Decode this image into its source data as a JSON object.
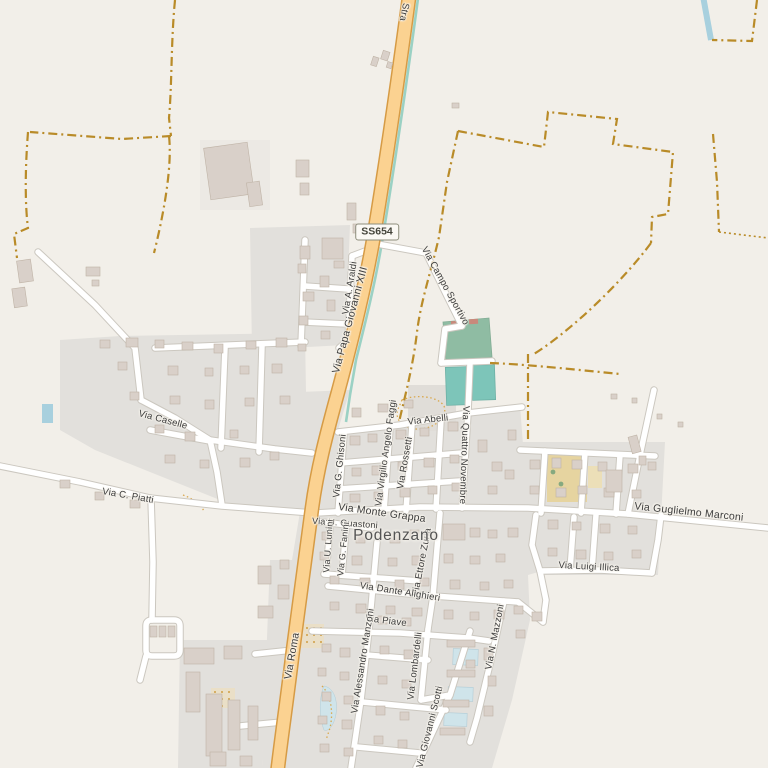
{
  "town": {
    "name": "Podenzano"
  },
  "road_shield": {
    "ref": "SS654"
  },
  "street_labels": [
    {
      "id": "strada-top",
      "text": "Stra"
    },
    {
      "id": "via-a-araldi",
      "text": "Via A. Araldi"
    },
    {
      "id": "via-papa-giovanni-xiii",
      "text": "Via Papa Giovanni XIII"
    },
    {
      "id": "via-campo-sportivo",
      "text": "Via Campo Sportivo"
    },
    {
      "id": "via-caselle",
      "text": "Via Caselle"
    },
    {
      "id": "via-c-piatti",
      "text": "Via C. Piatti"
    },
    {
      "id": "via-abelli",
      "text": "Via Abelli"
    },
    {
      "id": "via-quattro-novembre",
      "text": "Via Quattro Novembre"
    },
    {
      "id": "via-g-ghisoni",
      "text": "Via G. Ghisoni"
    },
    {
      "id": "via-virgilio-angelo-faggi",
      "text": "Via Virgilio Angelo Faggi"
    },
    {
      "id": "via-rossetti",
      "text": "Via Rossetti"
    },
    {
      "id": "via-monte-grappa",
      "text": "Via Monte Grappa"
    },
    {
      "id": "via-u-guastoni",
      "text": "Via U. Guastoni"
    },
    {
      "id": "via-u-lunini",
      "text": "Via U. Lunini"
    },
    {
      "id": "via-g-fanini",
      "text": "Via G. Fanini"
    },
    {
      "id": "via-ettore-zurla",
      "text": "Via Ettore Zurla"
    },
    {
      "id": "via-dante-alighieri",
      "text": "Via Dante Alighieri"
    },
    {
      "id": "via-piave",
      "text": "Via Piave"
    },
    {
      "id": "via-alessandro-manzoni",
      "text": "Via Alessandro Manzoni"
    },
    {
      "id": "via-lombardelli",
      "text": "Via Lombardelli"
    },
    {
      "id": "via-giovanni-scotti",
      "text": "Via Giovanni Scotti"
    },
    {
      "id": "via-n-mazzoni",
      "text": "Via N. Mazzoni"
    },
    {
      "id": "via-guglielmo-marconi",
      "text": "Via Guglielmo Marconi"
    },
    {
      "id": "via-luigi-illica",
      "text": "Via Luigi Illica"
    },
    {
      "id": "via-roma",
      "text": "Via Roma"
    }
  ],
  "colors": {
    "background": "#f2efe9",
    "residential": "#e2e0dc",
    "building_fill": "#d9d0c9",
    "building_stroke": "#bfb3a6",
    "primary_road_fill": "#fbd291",
    "primary_road_casing": "#d69b45",
    "minor_road_fill": "#ffffff",
    "minor_road_casing": "#cbc7bf",
    "admin_boundary": "#b98b28",
    "water": "#a8d0de",
    "pool": "#cfe4ea",
    "pitch": "#7dc5b9",
    "stadium": "#8fbca3",
    "school_yard": "#e6d4a0",
    "canal": "#9bd1c4"
  }
}
